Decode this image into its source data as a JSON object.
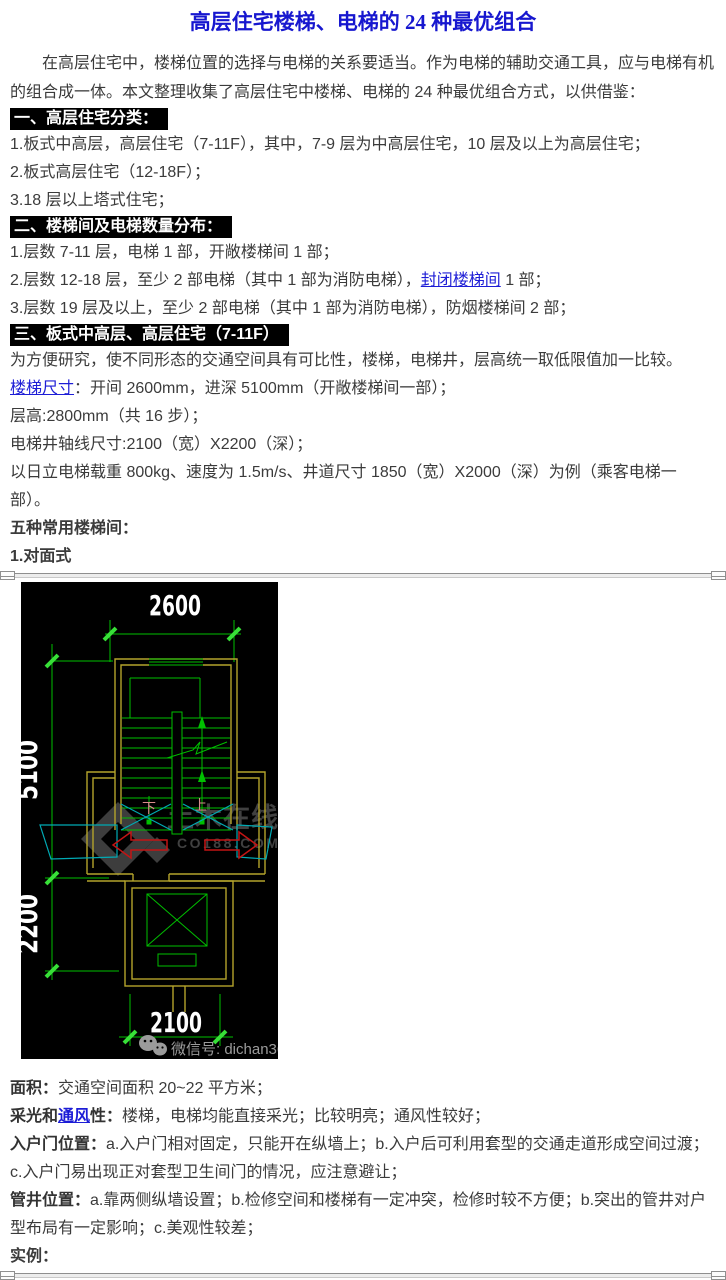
{
  "page": {
    "title": "高层住宅楼梯、电梯的 24 种最优组合"
  },
  "intro": "在高层住宅中，楼梯位置的选择与电梯的关系要适当。作为电梯的辅助交通工具，应与电梯有机的组合成一体。本文整理收集了高层住宅中楼梯、电梯的 24 种最优组合方式，以供借鉴：",
  "sections": {
    "h1": "一、高层住宅分类：",
    "h2": "二、楼梯间及电梯数量分布：",
    "h3": "三、板式中高层、高层住宅（7-11F）"
  },
  "lines": {
    "c1_1": "1.板式中高层，高层住宅（7-11F），其中，7-9 层为中高层住宅，10 层及以上为高层住宅；",
    "c1_2": "2.板式高层住宅（12-18F）；",
    "c1_3": "3.18 层以上塔式住宅；",
    "c2_1": "1.层数 7-11 层，电梯 1 部，开敞楼梯间 1 部；",
    "c2_2_pre": "2.层数 12-18 层，至少 2 部电梯（其中 1 部为消防电梯），",
    "c2_2_link": "封闭楼梯间",
    "c2_2_post": " 1 部；",
    "c2_3": "3.层数 19 层及以上，至少 2 部电梯（其中 1 部为消防电梯），防烟楼梯间 2 部；",
    "c3_1": "为方便研究，使不同形态的交通空间具有可比性，楼梯，电梯井，层高统一取低限值加一比较。",
    "c3_2_link": "楼梯尺寸",
    "c3_2_post": "：开间 2600mm，进深 5100mm（开敞楼梯间一部）；",
    "c3_3": "层高:2800mm（共 16 步）；",
    "c3_4": "电梯井轴线尺寸:2100（宽）X2200（深）；",
    "c3_5": "以日立电梯载重 800kg、速度为 1.5m/s、井道尺寸 1850（宽）X2000（深）为例（乘客电梯一部）。",
    "c3_6": "五种常用楼梯间：",
    "c3_7": "1.对面式"
  },
  "notes": {
    "area_label": "面积：",
    "area_text": "交通空间面积 20~22 平方米；",
    "light_label_pre": "采光和",
    "light_link": "通风",
    "light_label_post": "性：",
    "light_text": "楼梯，电梯均能直接采光；比较明亮；通风性较好；",
    "door_label": "入户门位置：",
    "door_text": "a.入户门相对固定，只能开在纵墙上；b.入户后可利用套型的交通走道形成空间过渡；c.入户门易出现正对套型卫生间门的情况，应注意避让；",
    "duct_label": "管井位置：",
    "duct_text": "a.靠两侧纵墙设置；b.检修空间和楼梯有一定冲突，检修时较不方便；b.突出的管井对户型布局有一定影响；c.美观性较差；",
    "example_label": "实例："
  },
  "cad": {
    "dim_top": "2600",
    "dim_left_upper": "5100",
    "dim_left_lower": "2200",
    "dim_bottom": "2100",
    "label_down": "下",
    "label_up": "上",
    "watermark_title": "土木在线",
    "watermark_site": "CO188.COM",
    "wechat_label": "微信号: dichan360",
    "colors": {
      "background": "#000000",
      "line_green": "#00bf00",
      "tick_green": "#38e038",
      "wall_yellow": "#b4a42c",
      "door_cyan": "#00aab4",
      "arrow_red": "#c31414",
      "label_pink": "#d98c8c",
      "dim_text_white": "#ffffff",
      "watermark_gray": "#404040",
      "wechat_gray": "#9b9b9b",
      "title_blue": "#1717cf",
      "link_blue": "#1d1dd6",
      "header_bg": "#000000",
      "header_fg": "#ffffff"
    }
  }
}
